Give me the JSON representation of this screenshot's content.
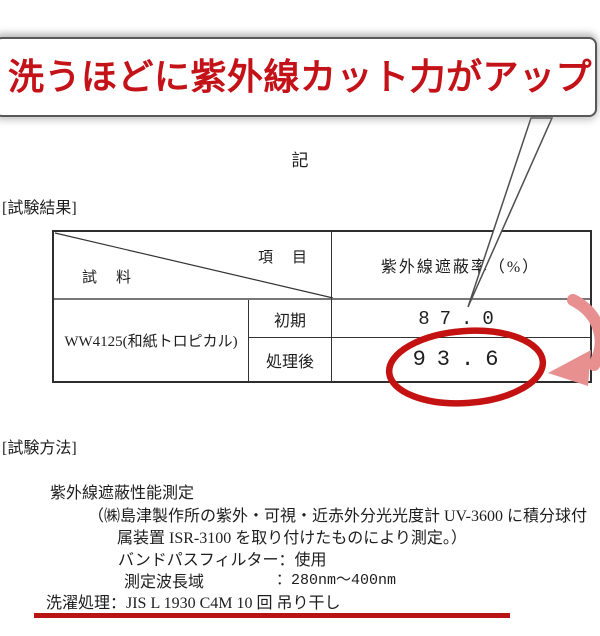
{
  "headline": {
    "text": "洗うほどに紫外線カット力がアップ",
    "color": "#c31218"
  },
  "memo_label": "記",
  "sections": {
    "results_label": "[試験結果]",
    "method_label": "[試験方法]"
  },
  "table": {
    "header": {
      "item_label": "項　目",
      "sample_label": "試　料",
      "value_column": "紫外線遮蔽率（%）"
    },
    "sample_name": "WW4125(和紙トロピカル)",
    "rows": [
      {
        "label": "初期",
        "value": "87.0"
      },
      {
        "label": "処理後",
        "value": "93.6",
        "highlighted": "red-ellipse"
      }
    ]
  },
  "method": {
    "title": "紫外線遮蔽性能測定",
    "line1": "（㈱島津製作所の紫外・可視・近赤外分光光度計 UV-3600 に積分球付",
    "line2": "属装置 ISR-3100 を取り付けたものにより測定。）",
    "line3": "バンドパスフィルター：使用",
    "wavelength_label": "測定波長域",
    "wavelength_value": "：280nm～400nm",
    "washing_line": "洗濯処理：JIS L 1930 C4M 10 回 吊り干し"
  },
  "annotations": {
    "callout_tail": "points-from-headline-to-value",
    "ellipse_color": "#c41212",
    "arrow_color": "#e89090",
    "underline_color": "#b91414",
    "border_color": "#585858"
  }
}
